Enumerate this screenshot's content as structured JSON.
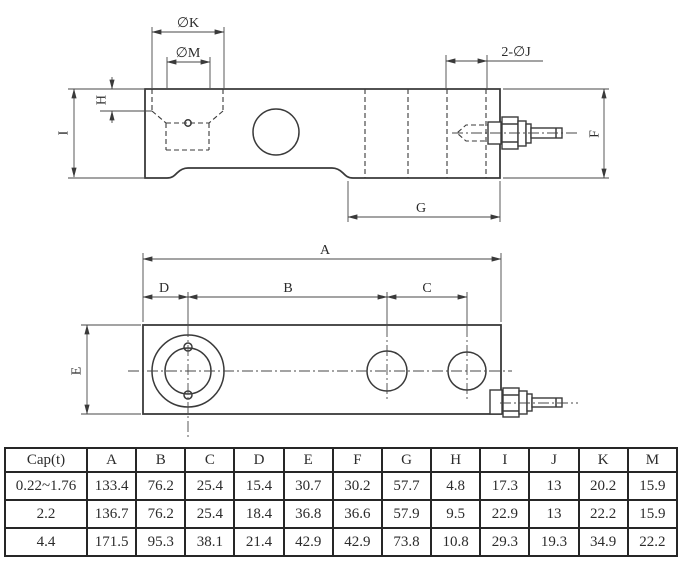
{
  "colors": {
    "line": "#3a3a3a",
    "dim": "#474747",
    "text": "#2b2b2b",
    "bg": "#ffffff",
    "table_border": "#262626"
  },
  "side_view": {
    "label_k": "∅K",
    "label_m": "∅M",
    "label_h": "H",
    "label_i": "I",
    "label_2j": "2-∅J",
    "label_f": "F",
    "label_g": "G"
  },
  "plan_view": {
    "label_a": "A",
    "label_b": "B",
    "label_c": "C",
    "label_d": "D",
    "label_e": "E"
  },
  "table": {
    "headers": [
      "Cap(t)",
      "A",
      "B",
      "C",
      "D",
      "E",
      "F",
      "G",
      "H",
      "I",
      "J",
      "K",
      "M"
    ],
    "rows": [
      [
        "0.22~1.76",
        "133.4",
        "76.2",
        "25.4",
        "15.4",
        "30.7",
        "30.2",
        "57.7",
        "4.8",
        "17.3",
        "13",
        "20.2",
        "15.9"
      ],
      [
        "2.2",
        "136.7",
        "76.2",
        "25.4",
        "18.4",
        "36.8",
        "36.6",
        "57.9",
        "9.5",
        "22.9",
        "13",
        "22.2",
        "15.9"
      ],
      [
        "4.4",
        "171.5",
        "95.3",
        "38.1",
        "21.4",
        "42.9",
        "42.9",
        "73.8",
        "10.8",
        "29.3",
        "19.3",
        "34.9",
        "22.2"
      ]
    ]
  }
}
